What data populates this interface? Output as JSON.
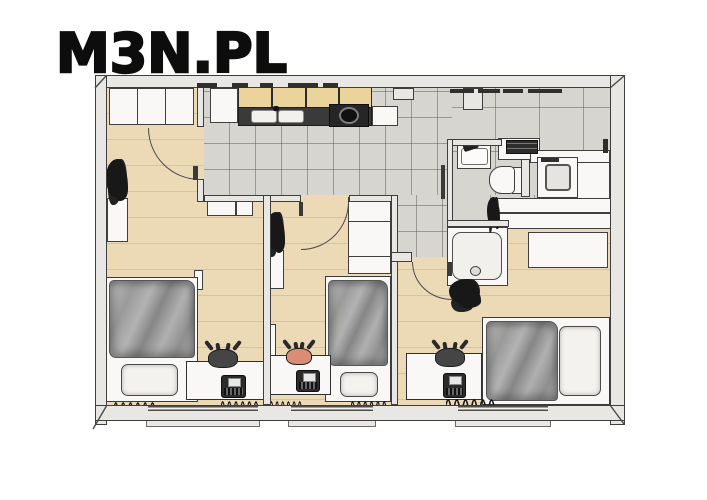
{
  "logo": {
    "text": "M3N.PL"
  },
  "colors": {
    "background": "#ffffff",
    "logo_text": "#0d0d0d",
    "wall_fill": "#e8e7e3",
    "wall_outline": "#3e3e3e",
    "wood_floor": "#ecd9b6",
    "wood_plank_line": "#dcc69e",
    "tile_floor": "#d7d5d0",
    "tile_grout": "#9d9b96",
    "cabinet_wood": "#ebd49b",
    "counter_dark": "#3a3a3a",
    "fixture_white": "#f9f8f6",
    "duvet_gray": "#a5a5a5",
    "pillow_white": "#f3f2ef",
    "chair_dark": "#454545",
    "chair_salmon": "#d98d74",
    "plant_dark": "#181818",
    "radiator_dark": "#141414"
  },
  "floorplan": {
    "view": "3d-top-down-apartment-floor-plan",
    "rooms": [
      {
        "name": "bedroom-left",
        "floor": "wood",
        "items": [
          "wardrobe",
          "wall-plant",
          "wall-shelf",
          "nightstands",
          "bed-gray-duvet",
          "white-pillow",
          "desk",
          "dark-desk-chair",
          "radio",
          "two-radiators",
          "window"
        ]
      },
      {
        "name": "kitchen",
        "floor": "tile",
        "items": [
          "tall-cabinet",
          "wood-upper-cabinets",
          "dark-countertop",
          "double-sink",
          "round-cooktop"
        ]
      },
      {
        "name": "bedroom-middle",
        "floor": "wood",
        "items": [
          "wardrobe",
          "wall-plant",
          "wall-shelf",
          "bed-gray-duvet",
          "white-pillow",
          "desk",
          "salmon-desk-chair",
          "radio",
          "two-radiators",
          "window"
        ]
      },
      {
        "name": "hallway",
        "floor": "tile",
        "items": [
          "door-to-bedroom-right"
        ]
      },
      {
        "name": "bathroom",
        "floor": "tile",
        "items": [
          "washbasin-with-faucet",
          "toilet",
          "shower-tray",
          "plant",
          "washing-machine",
          "dark-appliance",
          "white-counters"
        ]
      },
      {
        "name": "bedroom-right",
        "floor": "wood",
        "items": [
          "dresser",
          "bed-gray-duvet",
          "white-pillow",
          "desk",
          "dark-desk-chair",
          "radio",
          "radiator",
          "window"
        ]
      }
    ],
    "wall_features": [
      "top-wall-vent-dashes",
      "bottom-wall-windows-with-sills",
      "corner-perspective-lines"
    ]
  }
}
